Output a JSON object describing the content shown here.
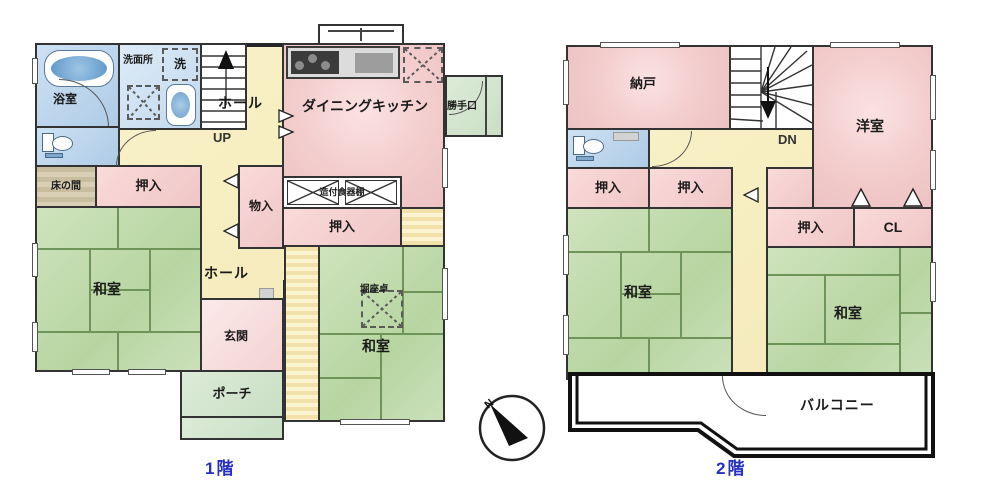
{
  "floor1": {
    "label": "1階",
    "rooms": {
      "bath": "浴室",
      "washroom": "洗面所",
      "laundry": "洗",
      "hall_upper": "ホール",
      "up": "UP",
      "dk": "ダイニングキッチン",
      "katteguchi": "勝手口",
      "tokonoma": "床の間",
      "oshiire_left": "押入",
      "mono": "物入",
      "cupboard": "造付食器棚",
      "oshiire_center": "押入",
      "washitsu_left": "和室",
      "hall_lower": "ホール",
      "genkan": "玄関",
      "horizataku": "堀座卓",
      "washitsu_right": "和室",
      "porch": "ポーチ"
    }
  },
  "floor2": {
    "label": "2階",
    "rooms": {
      "nando": "納戸",
      "dn": "DN",
      "yoshitsu": "洋室",
      "oshiire_a": "押入",
      "oshiire_b": "押入",
      "oshiire_c": "押入",
      "cl": "CL",
      "washitsu_left": "和室",
      "washitsu_right": "和室",
      "balcony": "バルコニー"
    }
  },
  "compass": {
    "north": "N"
  },
  "colors": {
    "wall": "#2b2b2b",
    "tatami_green": "#c2daad",
    "room_pink": "#f3cccc",
    "hall_yellow": "#f7eec2",
    "water_blue": "#c3d9ee",
    "porch_green": "#d5e6d0",
    "tokonoma_tan": "#cec3a6",
    "floor_label_blue": "#2330c0"
  }
}
